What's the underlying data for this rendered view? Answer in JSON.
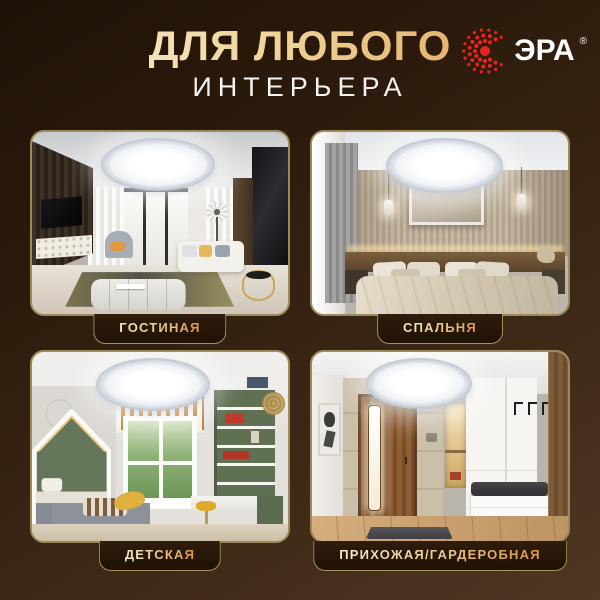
{
  "header": {
    "title_line1": "ДЛЯ ЛЮБОГО",
    "title_line2": "ИНТЕРЬЕРА"
  },
  "brand": {
    "name": "ЭРА",
    "registered_mark": "®",
    "icon": "era-sunburst-icon",
    "logo_red": "#e8231e"
  },
  "cards": [
    {
      "id": "living-room",
      "label": "ГОСТИНАЯ"
    },
    {
      "id": "bedroom",
      "label": "СПАЛЬНЯ"
    },
    {
      "id": "kids-room",
      "label": "ДЕТСКАЯ"
    },
    {
      "id": "hallway-wardrobe",
      "label": "ПРИХОЖАЯ/ГАРДЕРОБНАЯ"
    }
  ],
  "colors": {
    "background_top": "#1f1206",
    "background_bottom": "#503722",
    "card_border": "#9c8a5c",
    "badge_background": "#2f1d0d",
    "gold_light": "#faf3dc",
    "gold_dark": "#dd9c4f",
    "subtitle_white": "#f6f4f0"
  }
}
